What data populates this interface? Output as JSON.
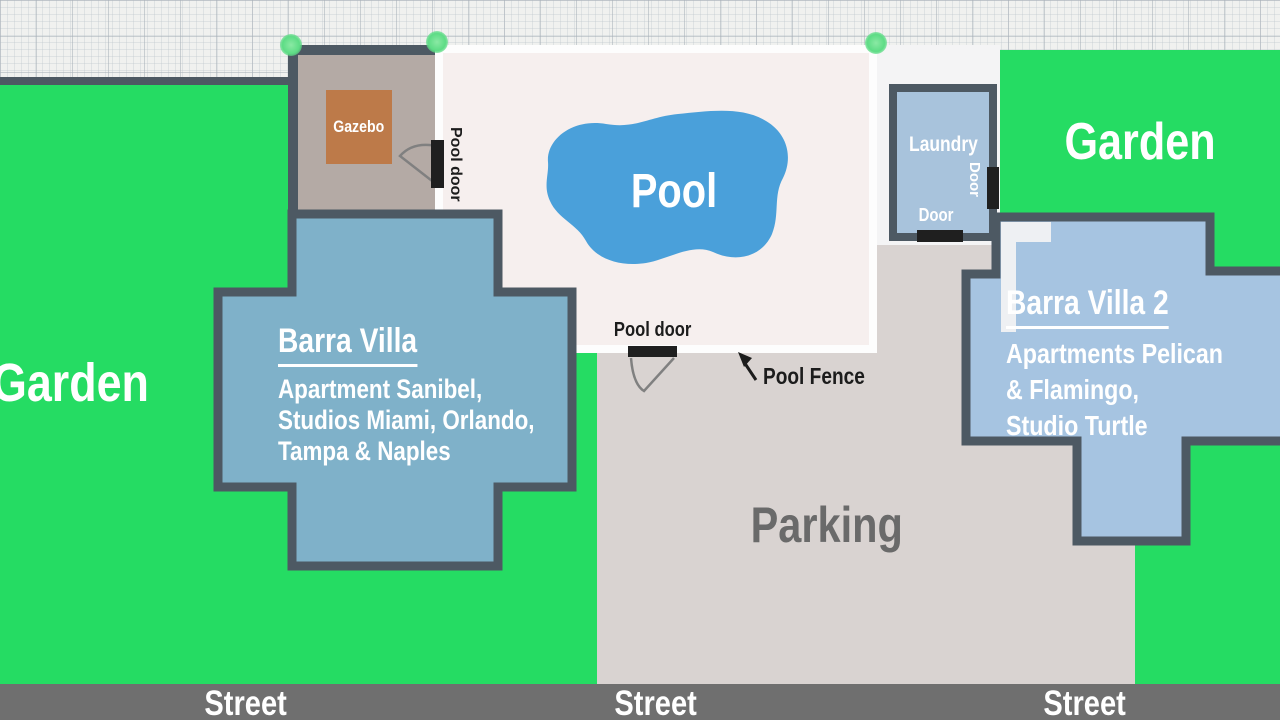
{
  "areas": {
    "garden_left": {
      "label": "Garden"
    },
    "garden_right": {
      "label": "Garden"
    },
    "pool": {
      "label": "Pool"
    },
    "parking": {
      "label": "Parking"
    },
    "gazebo": {
      "label": "Gazebo"
    },
    "laundry": {
      "label": "Laundry",
      "door_right_label": "Door",
      "door_bottom_label": "Door"
    }
  },
  "buildings": {
    "barra_villa": {
      "title": "Barra Villa",
      "lines": [
        "Apartment Sanibel,",
        "Studios Miami, Orlando,",
        "Tampa & Naples"
      ]
    },
    "barra_villa_2": {
      "title": "Barra Villa 2",
      "lines": [
        "Apartments Pelican",
        "& Flamingo,",
        "Studio Turtle"
      ]
    }
  },
  "annotations": {
    "pool_door_left": "Pool door",
    "pool_door_bottom": "Pool door",
    "pool_fence": "Pool Fence"
  },
  "streets": [
    "Street",
    "Street",
    "Street"
  ],
  "colors": {
    "garden_green": "#25DC63",
    "barra_villa_fill": "#7FB1C9",
    "barra_villa_2_fill": "#A6C4E1",
    "laundry_fill": "#A8C3DC",
    "pool_water": "#4AA0DA",
    "pool_deck": "#F6EFEE",
    "pool_fence_white": "#FDFDFD",
    "gazebo_square": "#BD7A49",
    "gazebo_area": "#B4AAA5",
    "parking_gray": "#D9D3D1",
    "street_gray": "#6F6F6F",
    "wall_border": "#4D5963",
    "door_black": "#1F1F1F"
  }
}
